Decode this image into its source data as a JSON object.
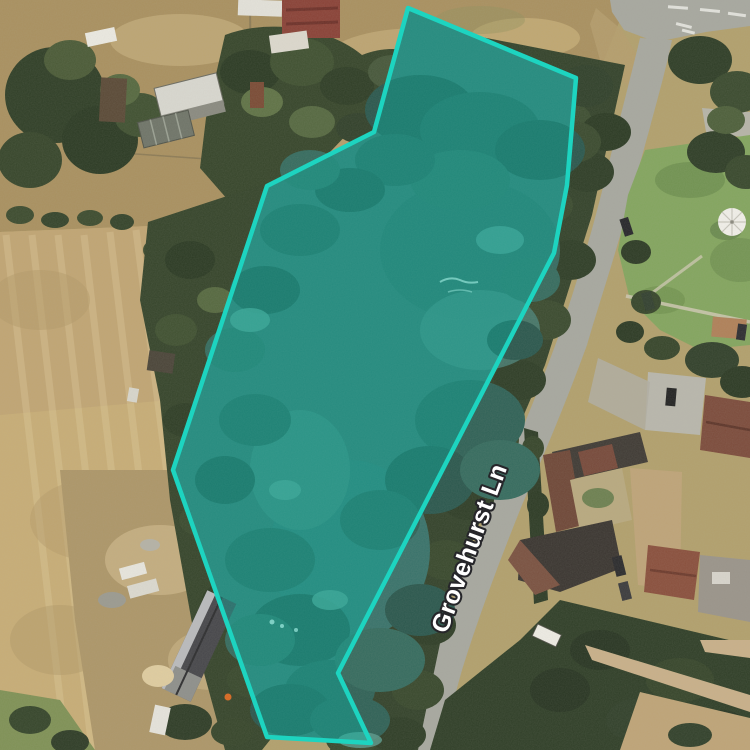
{
  "map": {
    "road_label": "Grovehurst Ln",
    "overlay_polygon": {
      "points": "408,8 576,78 567,185 554,253 338,673 371,743 267,737 173,470 267,186 374,132",
      "stroke_color": "#1dd4c0",
      "fill_color": "#00c2b0",
      "fill_opacity": "0.34",
      "stroke_width": "4.5"
    },
    "label_style": {
      "text_color": "#ffffff",
      "halo_color": "#26262a"
    }
  }
}
